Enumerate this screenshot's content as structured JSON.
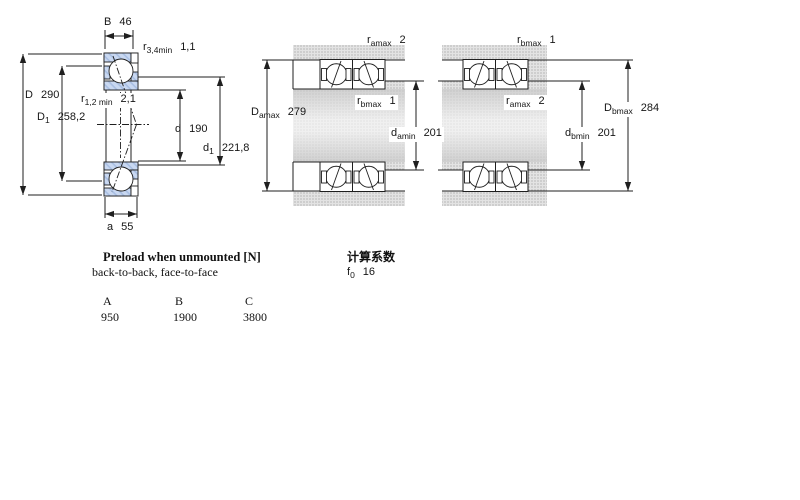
{
  "drawing": {
    "colors": {
      "line": "#1f1f1f",
      "ring_hatch_blue": "#c9d8f1",
      "ring_hatch_blue_dark": "#a9bfe3",
      "housing_gray": "#d9d9d9",
      "shaft_gradient_dark": "#c8c8c8",
      "shaft_gradient_light": "#f5f5f5"
    },
    "left": {
      "B": {
        "sym": "B",
        "val": "46"
      },
      "r34": {
        "sym": "r",
        "sub": "3,4min",
        "val": "1,1"
      },
      "D": {
        "sym": "D",
        "val": "290"
      },
      "D1": {
        "sym": "D",
        "sub": "1",
        "val": "258,2"
      },
      "r12": {
        "sym": "r",
        "sub": "1,2 min",
        "val": "2,1"
      },
      "d": {
        "sym": "d",
        "val": "190"
      },
      "d1": {
        "sym": "d",
        "sub": "1",
        "val": "221,8"
      },
      "a": {
        "sym": "a",
        "val": "55"
      }
    },
    "middle": {
      "ramax": {
        "sym": "r",
        "sub": "amax",
        "val": "2"
      },
      "rbmax": {
        "sym": "r",
        "sub": "bmax",
        "val": "1"
      },
      "Damax": {
        "sym": "D",
        "sub": "amax",
        "val": "279"
      },
      "damin": {
        "sym": "d",
        "sub": "amin",
        "val": "201"
      }
    },
    "right": {
      "rbmax": {
        "sym": "r",
        "sub": "bmax",
        "val": "1"
      },
      "ramax": {
        "sym": "r",
        "sub": "amax",
        "val": "2"
      },
      "Dbmax": {
        "sym": "D",
        "sub": "bmax",
        "val": "284"
      },
      "dbmin": {
        "sym": "d",
        "sub": "bmin",
        "val": "201"
      }
    }
  },
  "preload": {
    "title": "Preload when unmounted [N]",
    "subtitle": "back-to-back, face-to-face",
    "columns": [
      "A",
      "B",
      "C"
    ],
    "values": [
      "950",
      "1900",
      "3800"
    ]
  },
  "factors": {
    "title": "计算系数",
    "f0": {
      "sym": "f",
      "sub": "0",
      "val": "16"
    }
  }
}
